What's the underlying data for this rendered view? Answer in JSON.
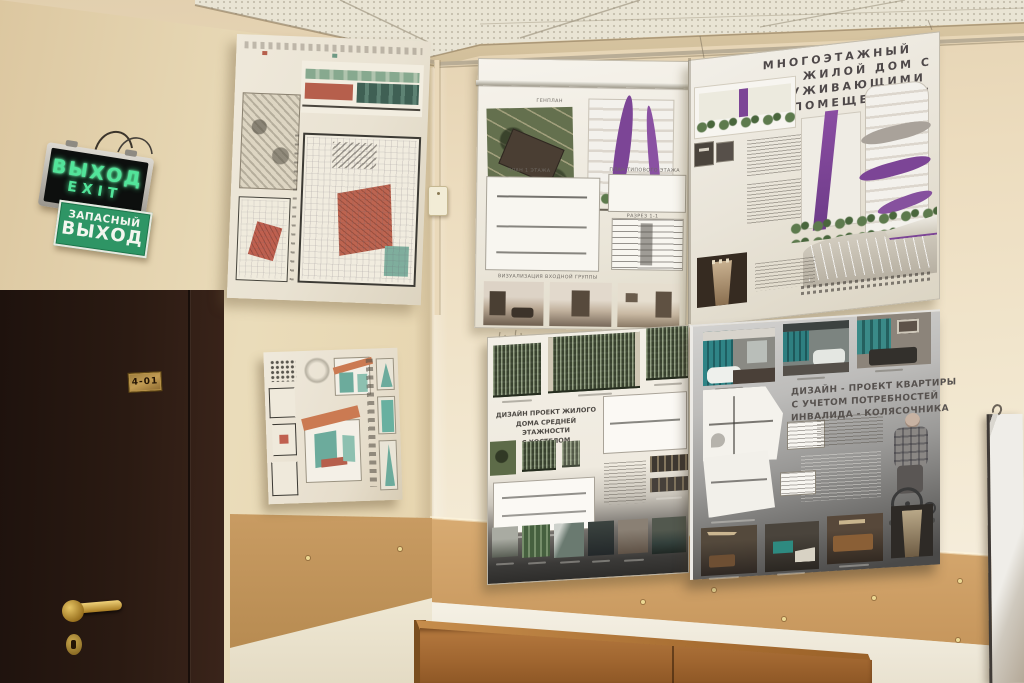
{
  "scene": {
    "description": "Photograph of a classroom corner: beige walls with wood wainscot, dark brown door, emergency exit signs, wooden cabinet, and four architectural student project posters"
  },
  "exit_sign_box": {
    "line1": "ВЫХОД",
    "line2": "EXIT"
  },
  "exit_sign_green": {
    "line1": "ЗАПАСНЫЙ",
    "line2": "ВЫХОД"
  },
  "door": {
    "room_plate": "4-01"
  },
  "poster_top_right": {
    "title_lines": [
      "МНОГОЭТАЖНЫЙ",
      "ЖИЛОЙ ДОМ С",
      "ОБСЛУЖИВАЮЩИМИ",
      "ПОМЕЩЕНИЯМИ"
    ],
    "label_genplan": "ГЕНПЛАН",
    "label_plan1": "ПЛАН 1 ЭТАЖА",
    "label_plan_typ": "ПЛАН ТИПОВОГО ЭТАЖА",
    "label_razrez": "РАЗРЕЗ 1-1",
    "label_visual": "ВИЗУАЛИЗАЦИЯ ВХОДНОЙ ГРУППЫ"
  },
  "poster_bottom_middle": {
    "title_lines": [
      "ДИЗАЙН ПРОЕКТ ЖИЛОГО",
      "ДОМА СРЕДНЕЙ ЭТАЖНОСТИ",
      "С ХОСТЕЛОМ"
    ]
  },
  "poster_bottom_right": {
    "title_lines": [
      "ДИЗАЙН - ПРОЕКТ КВАРТИРЫ",
      "С УЧЕТОМ ПОТРЕБНОСТЕЙ",
      "ИНВАЛИДА - КОЛЯСОЧНИКА"
    ]
  },
  "colors": {
    "wall_beige": "#ecdcbd",
    "wainscot_wood": "#cfa066",
    "cabinet_wood": "#ad6f33",
    "door_brown": "#2a1a12",
    "exit_text_green": "#52e49a",
    "sign_green": "#2e9565",
    "poster_purple": "#7c4596",
    "render_teal": "#2f8486",
    "facade_green": "#4d5840"
  }
}
